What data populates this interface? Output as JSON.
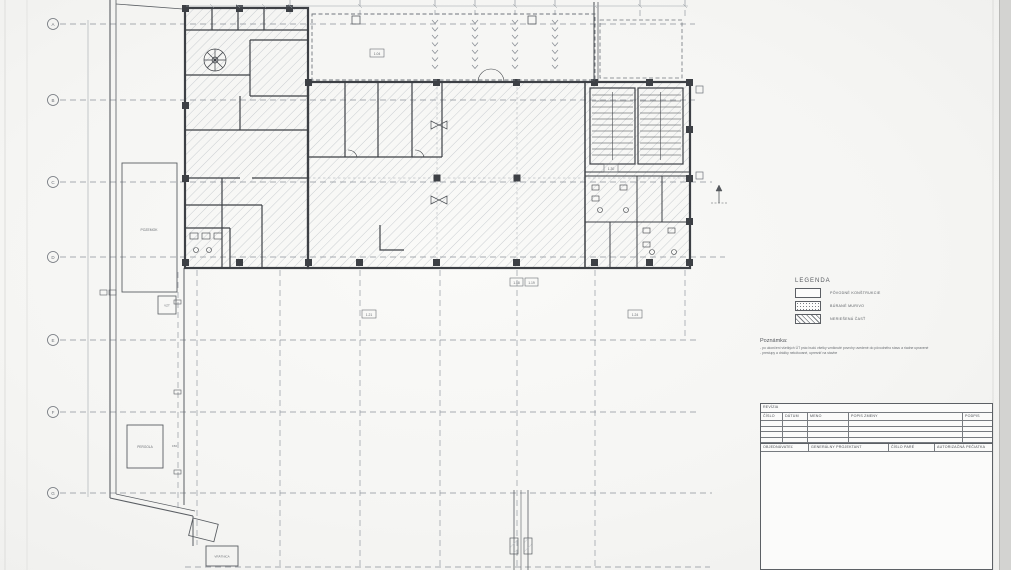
{
  "axes": {
    "left": [
      {
        "label": "A"
      },
      {
        "label": "B"
      },
      {
        "label": "C"
      },
      {
        "label": "D"
      },
      {
        "label": "E"
      },
      {
        "label": "F"
      },
      {
        "label": "G"
      }
    ]
  },
  "legend": {
    "title": "LEGENDA",
    "items": [
      {
        "label": "PÔVODNÉ KONŠTRUKCIE",
        "swatch": "empty"
      },
      {
        "label": "BÚRANÉ MURIVO",
        "swatch": "dotted"
      },
      {
        "label": "NERIEŠENÁ ČASŤ",
        "swatch": "hatched"
      }
    ]
  },
  "note": {
    "title": "Poznámka:",
    "lines": [
      "- po ukončení všetkých ÚT prác budú všetky vzniknuté povrchy uvedené do pôvodného stavu a riadne upravené",
      "- prestupy a drážky nekótované, upresniť na stavbe"
    ]
  },
  "title_block": {
    "revision": "REVÍZIA",
    "headers": [
      "ČÍSLO",
      "DÁTUM",
      "MENO",
      "POPIS ZMENY",
      "PODPIS"
    ],
    "footer": [
      "OBJEDNÁVATEĽ",
      "GENERÁLNY PROJEKTANT",
      "ČÍSLO PARÉ",
      "AUTORIZAČNÁ PEČIATKA"
    ]
  },
  "site": {
    "plot_label": "POZEMOK",
    "vzt_label": "VZT",
    "pergola_label": "PERGOLA",
    "pergola_elev": "150",
    "gatehouse_label": "VRÁTNICA"
  },
  "tags": {
    "court": "1.04",
    "stair": "1.30",
    "t1": "1.18",
    "t2": "1.19",
    "t3": "1.21",
    "t4": "1.24"
  }
}
